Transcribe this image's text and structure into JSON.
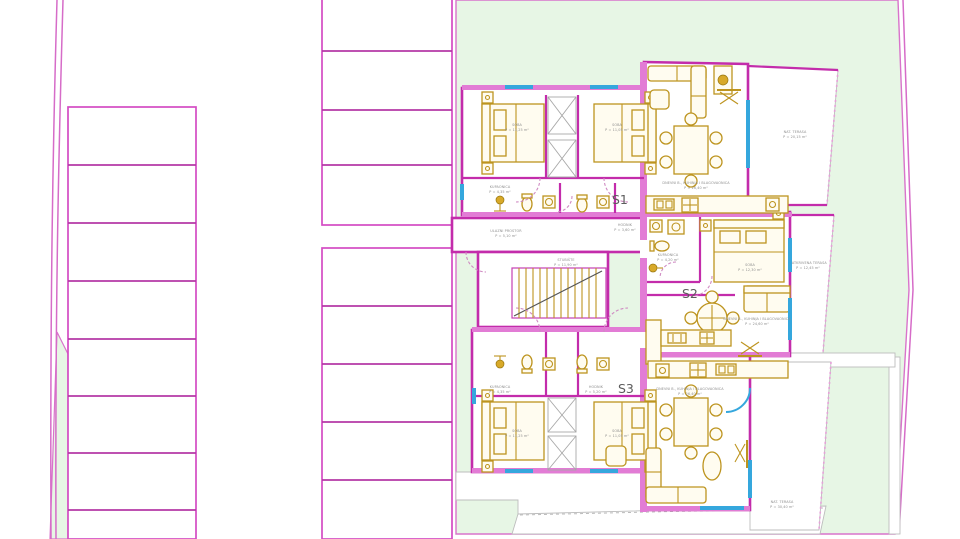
{
  "plan": {
    "title": "Floor plan – three apartments with parking and garden",
    "apartments": [
      {
        "id": "s1",
        "label": "S1"
      },
      {
        "id": "s2",
        "label": "S2"
      },
      {
        "id": "s3",
        "label": "S3"
      }
    ],
    "rooms": {
      "s1_room1": {
        "name": "SOBA",
        "area": "P = 11,25 m²"
      },
      "s1_room2": {
        "name": "SOBA",
        "area": "P = 11,05 m²"
      },
      "s1_bath": {
        "name": "KUPAONICA",
        "area": "P = 4,35 m²"
      },
      "s1_living": {
        "name": "DNEVNI B., KUHINJA I BLAGOVAONICA",
        "area": "P = 26,40 m²"
      },
      "s2_bath": {
        "name": "KUPAONICA",
        "area": "P = 4,20 m²"
      },
      "s2_hall": {
        "name": "HODNIK",
        "area": "P = 3,60 m²"
      },
      "s2_room": {
        "name": "SOBA",
        "area": "P = 12,30 m²"
      },
      "s2_living": {
        "name": "DNEVNI B., KUHINJA I BLAGOVAONICA",
        "area": "P = 24,60 m²"
      },
      "s3_bath": {
        "name": "KUPAONICA",
        "area": "P = 4,35 m²"
      },
      "s3_hall": {
        "name": "HODNIK",
        "area": "P = 5,20 m²"
      },
      "s3_room1": {
        "name": "SOBA",
        "area": "P = 11,25 m²"
      },
      "s3_room2": {
        "name": "SOBA",
        "area": "P = 11,05 m²"
      },
      "s3_living": {
        "name": "DNEVNI B., KUHINJA I BLAGOVAONICA",
        "area": "P = 26,40 m²"
      },
      "entry": {
        "name": "ULAZNI PROSTOR",
        "area": "P = 5,10 m²"
      },
      "stairs": {
        "name": "STUBIŠTE",
        "area": "P = 11,90 m²"
      },
      "terrace_top": {
        "name": "NAT. TERASA",
        "area": "P = 20,15 m²"
      },
      "terrace_mid": {
        "name": "NATKRIVENA TERASA",
        "area": "P = 12,45 m²"
      },
      "terrace_bottom": {
        "name": "NAT. TERASA",
        "area": "P = 30,40 m²"
      }
    },
    "parking": {
      "left_stalls": 8,
      "middle_top_stalls": 4,
      "middle_bottom_stalls": 5
    },
    "colors": {
      "wall_magenta": "#c32cab",
      "partition_pink": "#e27cd5",
      "site_boundary": "#d66cc8",
      "garden_green": "#e7f6e5",
      "window_cyan": "#35a7dd",
      "furniture_gold": "#bd941f",
      "label_gray": "#8f8f8f"
    }
  }
}
